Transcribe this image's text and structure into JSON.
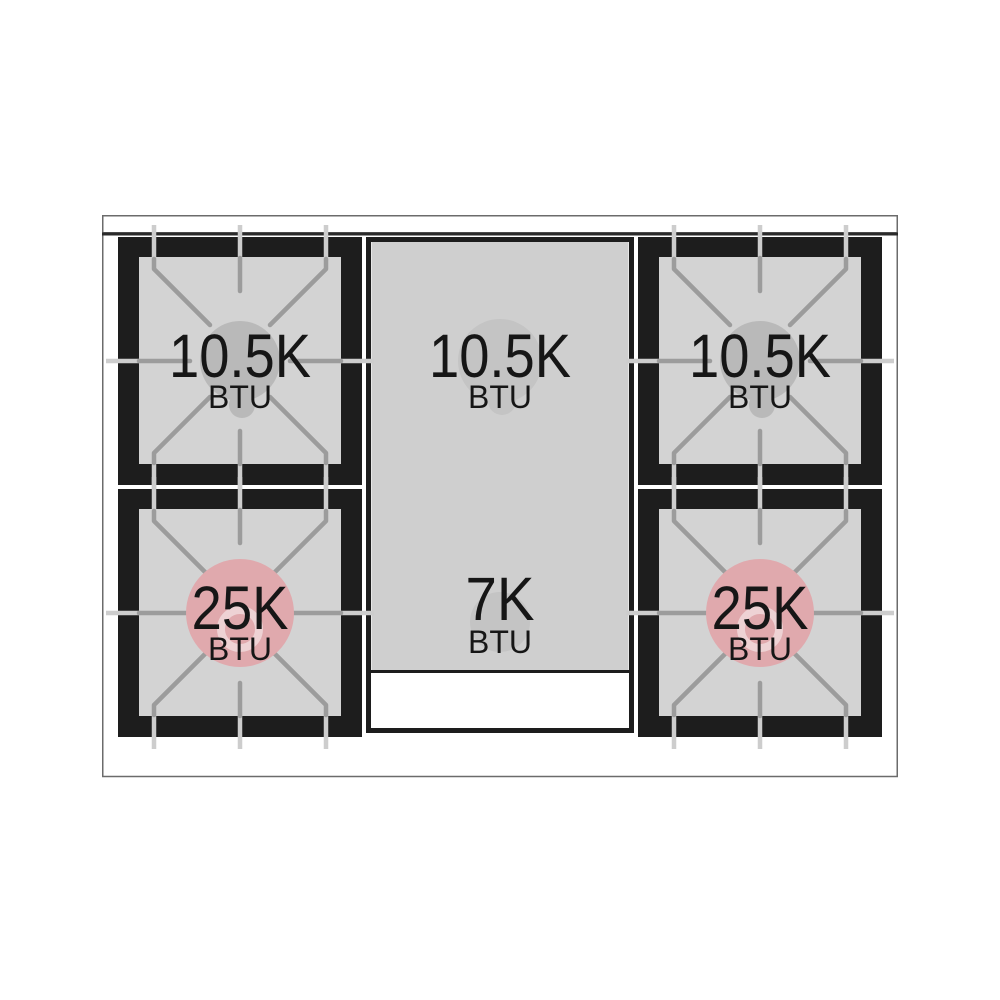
{
  "title": "Gas range cooktop burner layout diagram",
  "diagram": {
    "kind": "cooktop-top-view",
    "burners": [
      {
        "position": "top-left",
        "rating": "10.5K",
        "unit": "BTU"
      },
      {
        "position": "top-center",
        "rating": "10.5K",
        "unit": "BTU"
      },
      {
        "position": "top-right",
        "rating": "10.5K",
        "unit": "BTU"
      },
      {
        "position": "bottom-left",
        "rating": "25K",
        "unit": "BTU"
      },
      {
        "position": "bottom-center",
        "rating": "7K",
        "unit": "BTU"
      },
      {
        "position": "bottom-right",
        "rating": "25K",
        "unit": "BTU"
      }
    ],
    "colors": {
      "frame_black": "#1d1d1d",
      "burner_surface": "#d3d3d3",
      "griddle_surface": "#cfcfcf",
      "grate_line": "#9c9c9c",
      "frame_tick": "#cdcdcd",
      "cap_gray": "#b9b9b9",
      "cap_griddle_gray": "#c4c4c4",
      "cap_pink": "#e0a9ad",
      "cap_pink_ring": "#eed2d4",
      "label_text": "#161616",
      "body_outline": "#6b6b6b"
    }
  }
}
